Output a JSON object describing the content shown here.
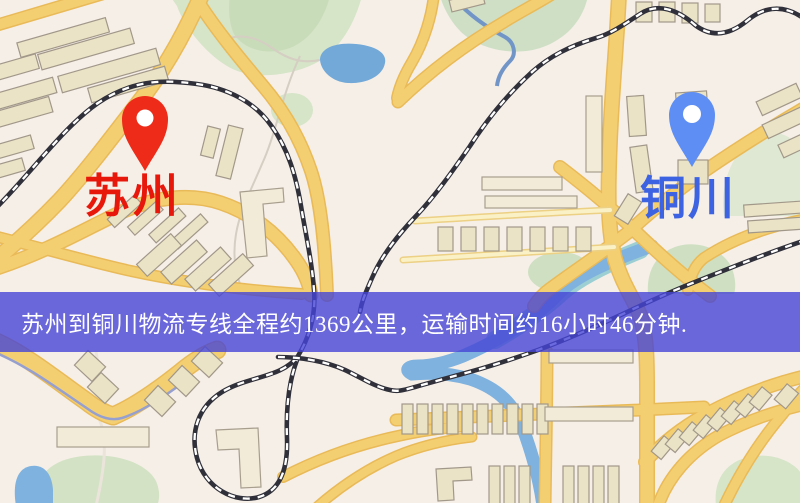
{
  "map": {
    "origin": {
      "name": "苏州",
      "pin_icon": "red-map-pin"
    },
    "destination": {
      "name": "铜川",
      "pin_icon": "blue-map-pin"
    }
  },
  "banner": {
    "text": "苏州到铜川物流专线全程约1369公里，运输时间约16小时46分钟."
  },
  "colors": {
    "origin_pin": "#ee2b18",
    "destination_pin": "#5e8ef4",
    "origin_label": "#e8170c",
    "destination_label": "#3d63e3",
    "banner_background": "rgba(70,69,214,0.8)",
    "road": "#f4cf72",
    "minor_road": "#fbf1c6",
    "water": "#72a9d8",
    "park": "#d6e4c8",
    "building": "#ebe3c6",
    "background": "#f6efe8"
  }
}
